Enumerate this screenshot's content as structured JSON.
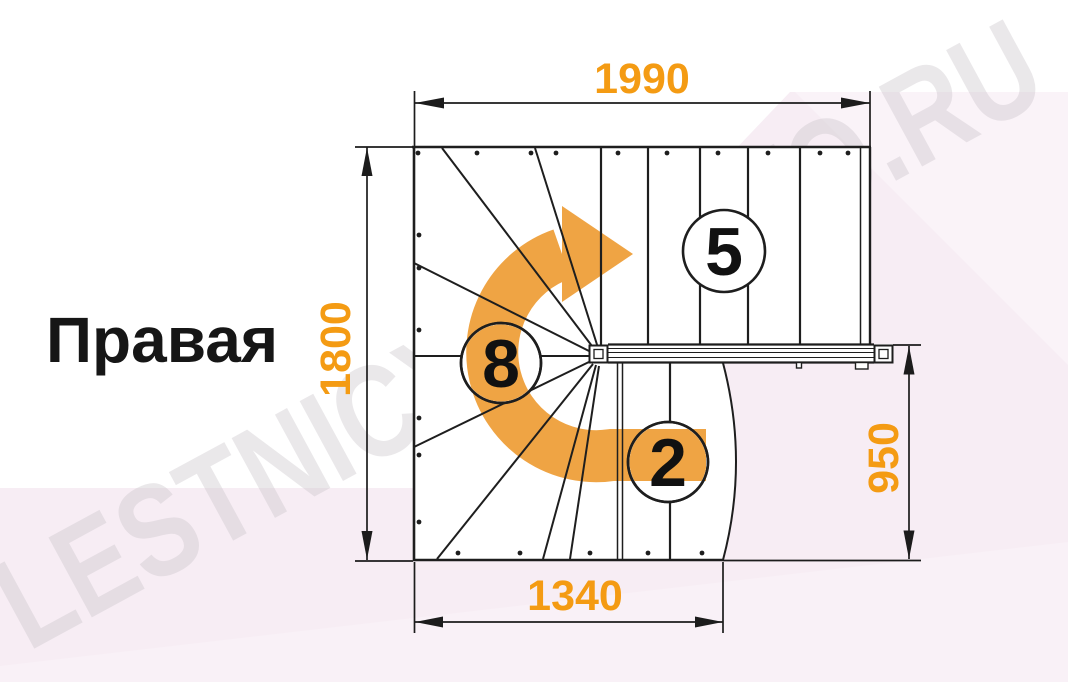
{
  "diagram": {
    "label": "Правая",
    "watermark": "LESTNICYPROSTO.RU",
    "dimensions": {
      "top": "1990",
      "left": "1800",
      "right": "950",
      "bottom": "1340"
    },
    "step_labels": {
      "upper_flight": "5",
      "winders": "8",
      "lower_flight": "2"
    },
    "colors": {
      "dimension_text": "#F49B13",
      "direction_arrow": "#EFA444",
      "line": "#1E1E1E",
      "background_tint": "#F7EDF4",
      "watermark_gray": "#C9C2C9"
    }
  }
}
